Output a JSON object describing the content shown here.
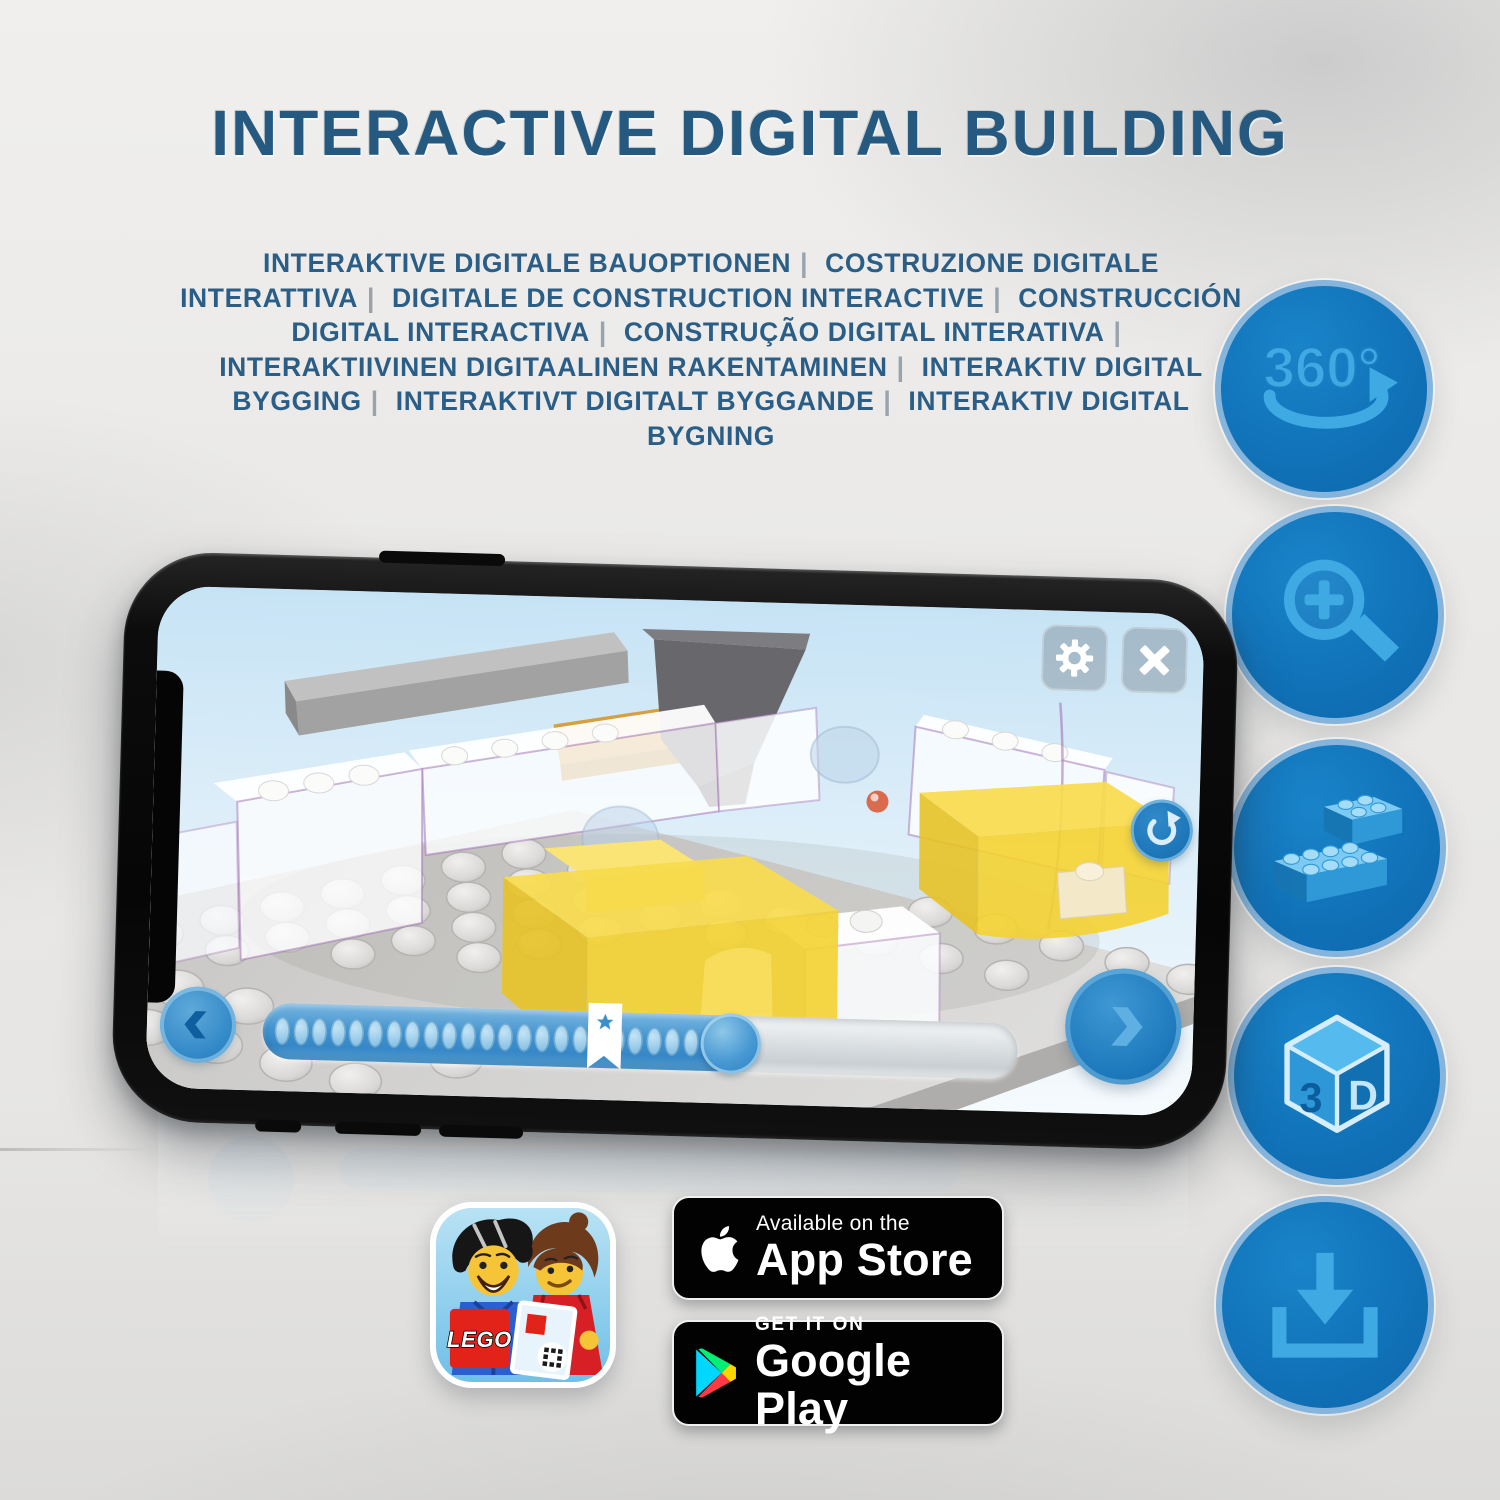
{
  "header": {
    "title": "INTERACTIVE DIGITAL BUILDING",
    "subtitle": {
      "separator": "|",
      "parts": [
        "INTERAKTIVE DIGITALE BAUOPTIONEN",
        "COSTRUZIONE DIGITALE INTERATTIVA",
        "DIGITALE DE CONSTRUCTION INTERACTIVE",
        "CONSTRUCCIÓN DIGITAL INTERACTIVA",
        "CONSTRUÇÃO DIGITAL INTERATIVA",
        "INTERAKTIIVINEN DIGITAALINEN RAKENTAMINEN",
        "INTERAKTIV DIGITAL BYGGING",
        "INTERAKTIVT DIGITALT BYGGANDE",
        "INTERAKTIV DIGITAL BYGNING"
      ]
    }
  },
  "features": [
    {
      "icon": "rotate-360-icon",
      "label": "360°"
    },
    {
      "icon": "zoom-in-magnifier-icon"
    },
    {
      "icon": "stacked-bricks-icon"
    },
    {
      "icon": "cube-3d-icon",
      "left_face": "3",
      "right_face": "D"
    },
    {
      "icon": "download-icon"
    }
  ],
  "phone": {
    "screen": {
      "toolbar": {
        "settings_icon": "gear-icon",
        "close_icon": "close-icon"
      },
      "rotate_reset_icon": "rotate-reset-icon",
      "nav": {
        "back_icon": "chevron-left-icon",
        "next_icon": "chevron-right-icon"
      },
      "progress": {
        "fill_percent": 64,
        "knob_percent": 62,
        "bookmark_percent": 43,
        "dot_count": 23,
        "bookmark_icon": "star-icon"
      }
    }
  },
  "store": {
    "lego_app_icon": {
      "logo_text": "LEGO"
    },
    "app_store_badge": {
      "tagline": "Available on the",
      "name": "App Store",
      "icon": "apple-icon"
    },
    "google_play_badge": {
      "tagline": "GET IT ON",
      "name": "Google Play",
      "icon": "play-triangle-icon"
    }
  },
  "colors": {
    "title_blue": "#26597F",
    "badge_fill": "#1173B9",
    "badge_rim": "#85B5DC",
    "icon_glyph_blue": "#3FA9E4",
    "screen_sky": "#CDE8F7",
    "brick_yellow": "#F5D63F",
    "progress_blue": "#4394CF"
  }
}
